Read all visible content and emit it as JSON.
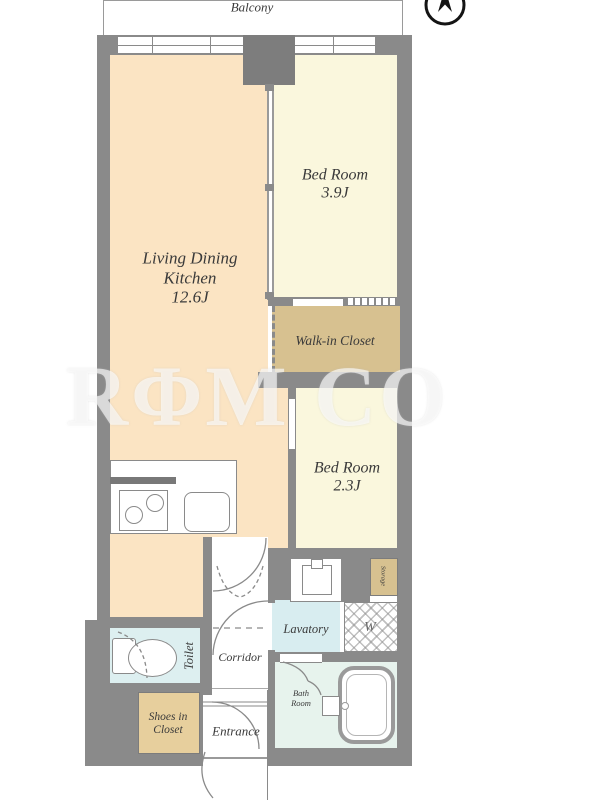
{
  "plan": {
    "balcony_label": "Balcony",
    "watermark": {
      "text": "RΦM CO"
    },
    "rooms": {
      "ldk": {
        "line1": "Living Dining",
        "line2": "Kitchen",
        "size": "12.6J"
      },
      "bedroom1": {
        "name": "Bed Room",
        "size": "3.9J"
      },
      "bedroom2": {
        "name": "Bed Room",
        "size": "2.3J"
      },
      "wic": {
        "name": "Walk-in Closet"
      },
      "lavatory": {
        "name": "Lavatory"
      },
      "washer": {
        "name": "W"
      },
      "toilet": {
        "name": "Toilet"
      },
      "corridor": {
        "name": "Corridor"
      },
      "shoes": {
        "line1": "Shoes in",
        "line2": "Closet"
      },
      "entrance": {
        "name": "Entrance"
      },
      "bath": {
        "line1": "Bath",
        "line2": "Room"
      },
      "storage": {
        "name": "Storage"
      }
    },
    "colors": {
      "wall": "#8a8a8a",
      "ldk_floor": "#fbe4c3",
      "bedroom_floor": "#faf7dd",
      "closet_tan": "#d7c190",
      "shoes_tan": "#e7cf9d",
      "toilet_blue": "#ddeff0",
      "lavatory_blue": "#d8edf0",
      "bath_mint": "#e7f3ed"
    }
  }
}
